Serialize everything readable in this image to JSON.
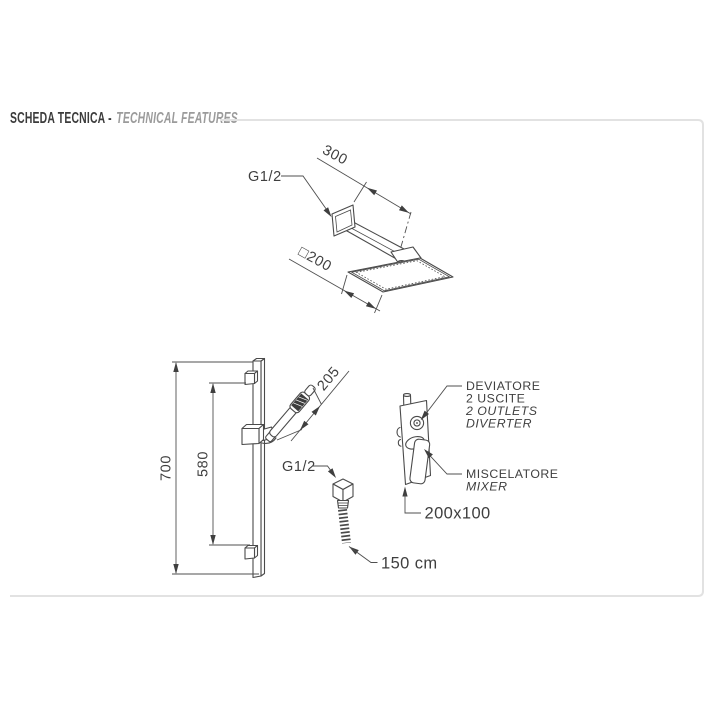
{
  "header": {
    "title_primary": "SCHEDA TECNICA -",
    "title_secondary": "TECHNICAL FEATURES"
  },
  "overhead_shower": {
    "connection": "G1/2",
    "arm_length": "300",
    "head_size": "□200"
  },
  "slide_rail": {
    "total_height": "700",
    "bracket_span": "580",
    "handshower_length": "205",
    "water_outlet": "G1/2",
    "hose_length": "150 cm"
  },
  "mixer": {
    "diverter_line1": "DEVIATORE",
    "diverter_line2": "2 USCITE",
    "diverter_line3": "2 OUTLETS",
    "diverter_line4": "DIVERTER",
    "mixer_line1": "MISCELATORE",
    "mixer_line2": "MIXER",
    "plate_size": "200x100"
  },
  "colors": {
    "line": "#4a4a4a",
    "text": "#3f3f3f",
    "panel_border": "#e2e2e2",
    "title_primary": "#3b3b3b",
    "title_secondary": "#9b9b9b"
  }
}
